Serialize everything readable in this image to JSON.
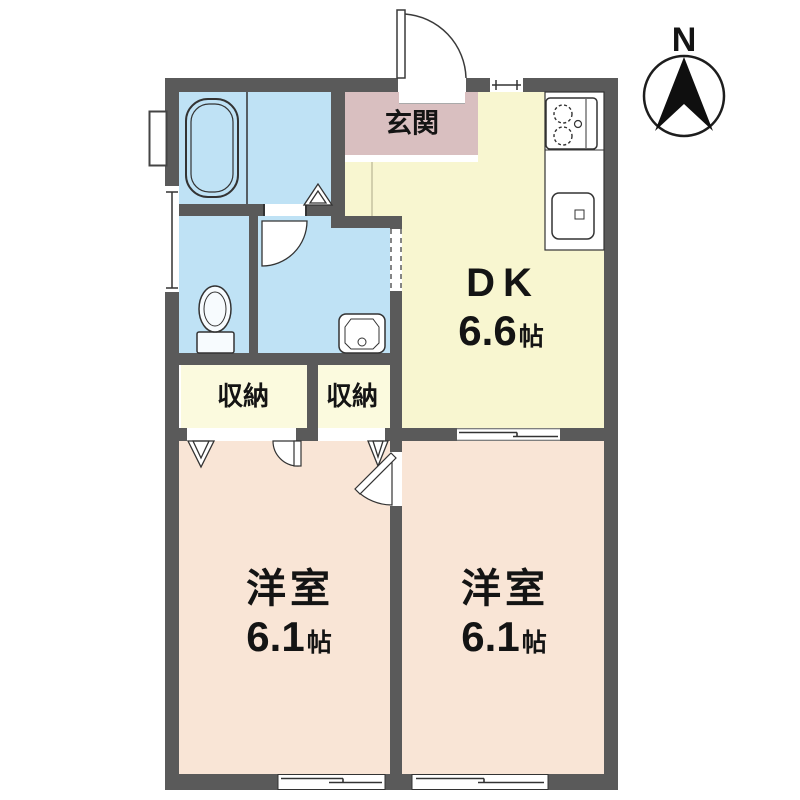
{
  "plan": {
    "compass": {
      "north_label": "N"
    },
    "rooms": {
      "entrance": {
        "label": "玄関"
      },
      "dining_kitchen": {
        "label": "DK",
        "size": "6.6",
        "unit": "帖"
      },
      "closet_left": {
        "label": "収納"
      },
      "closet_right": {
        "label": "収納"
      },
      "western_room_left": {
        "label": "洋室",
        "size": "6.1",
        "unit": "帖"
      },
      "western_room_right": {
        "label": "洋室",
        "size": "6.1",
        "unit": "帖"
      }
    },
    "colors": {
      "wall": "#5a5a5a",
      "water_rooms": "#bfe2f5",
      "dining_kitchen": "#f8f6d0",
      "closets": "#fbfade",
      "western_rooms": "#f9e5d6",
      "entrance": "#d9bfc0",
      "text": "#141414"
    }
  }
}
